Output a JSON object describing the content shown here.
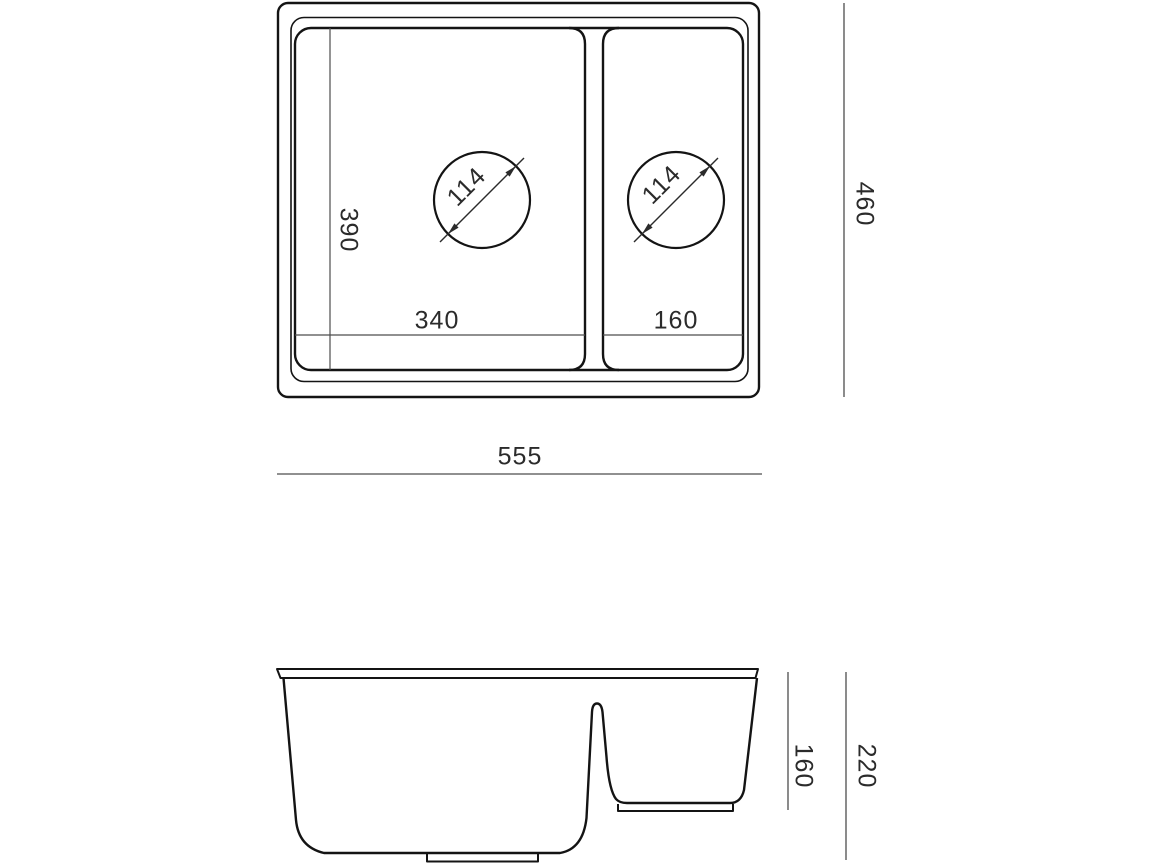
{
  "drawing": {
    "type": "technical-dimension-drawing",
    "subject": "kitchen sink with one and a half bowls",
    "views": {
      "top": {
        "labels": {
          "overall_width": "555",
          "overall_height": "460",
          "bowl_main_width": "340",
          "bowl_small_width": "160",
          "bowl_main_depth": "390",
          "drain_main_diameter": "114",
          "drain_small_diameter": "114"
        }
      },
      "side": {
        "labels": {
          "bowl_small_height": "160",
          "bowl_main_height": "220"
        }
      }
    },
    "colors": {
      "background": "#ffffff",
      "outline": "#141414",
      "dimension_line": "#4d4d4d",
      "text": "#2b2b2b"
    }
  }
}
